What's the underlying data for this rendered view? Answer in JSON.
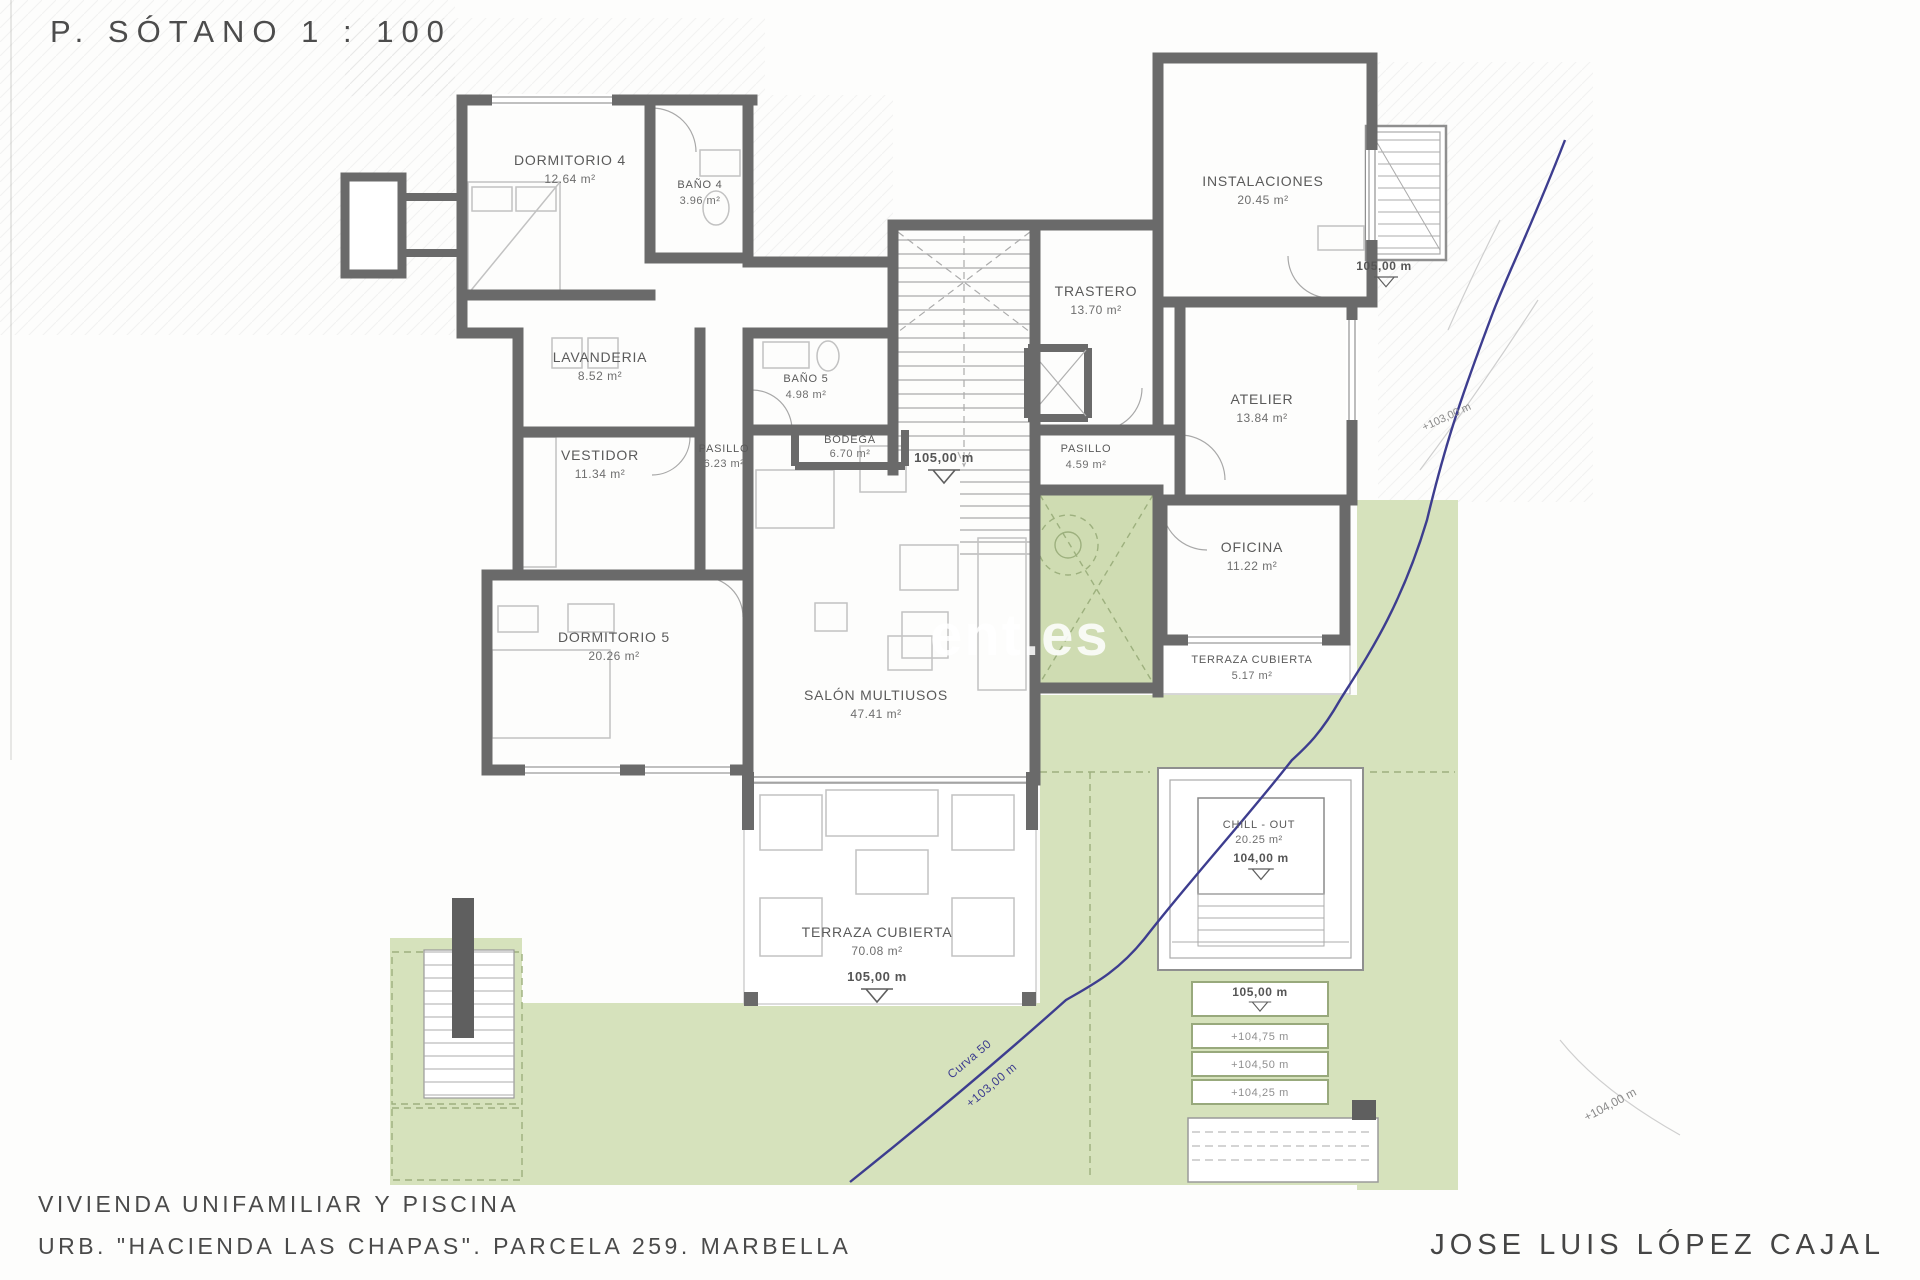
{
  "title": "P. SÓTANO 1 : 100",
  "watermark": "ent.es",
  "rooms": [
    {
      "name": "DORMITORIO 4",
      "area": "12.64 m²"
    },
    {
      "name": "BAÑO 4",
      "area": "3.96 m²"
    },
    {
      "name": "LAVANDERIA",
      "area": "8.52 m²"
    },
    {
      "name": "VESTIDOR",
      "area": "11.34 m²"
    },
    {
      "name": "PASILLO",
      "area": "6.23 m²"
    },
    {
      "name": "BAÑO 5",
      "area": "4.98 m²"
    },
    {
      "name": "BODEGA",
      "area": "6.70 m²"
    },
    {
      "name": "DORMITORIO 5",
      "area": "20.26 m²"
    },
    {
      "name": "SALÓN MULTIUSOS",
      "area": "47.41 m²"
    },
    {
      "name": "TRASTERO",
      "area": "13.70 m²"
    },
    {
      "name": "PASILLO",
      "area": "4.59 m²"
    },
    {
      "name": "INSTALACIONES",
      "area": "20.45 m²"
    },
    {
      "name": "ATELIER",
      "area": "13.84 m²"
    },
    {
      "name": "OFICINA",
      "area": "11.22 m²"
    },
    {
      "name": "TERRAZA CUBIERTA",
      "area": "5.17 m²"
    },
    {
      "name": "TERRAZA CUBIERTA",
      "area": "70.08 m²"
    },
    {
      "name": "CHILL - OUT",
      "area": "20.25 m²"
    }
  ],
  "levels": {
    "hall": "105,00 m",
    "stair_landing": "105,00 m",
    "terrace": "105,00 m",
    "chillout": "104,00 m",
    "steps_top": "105,00 m",
    "step_1": "+104,75 m",
    "step_2": "+104,50 m",
    "step_3": "+104,25 m",
    "contour_right": "+103,00 m",
    "contour_bottom": "+104,00 m",
    "curve_name": "Curva 50",
    "curve_level": "+103,00 m"
  },
  "footer": {
    "line1": "VIVIENDA UNIFAMILIAR Y PISCINA",
    "line2": "URB. \"HACIENDA LAS CHAPAS\". PARCELA 259. MARBELLA",
    "architect": "JOSE LUIS LÓPEZ CAJAL"
  },
  "colors": {
    "walls": "#6a6a6a",
    "green": "#d6e2bc",
    "patio_green": "#cfdcb2",
    "boundary_blue": "#3d3d8f",
    "label_text": "#5a5a5a"
  }
}
